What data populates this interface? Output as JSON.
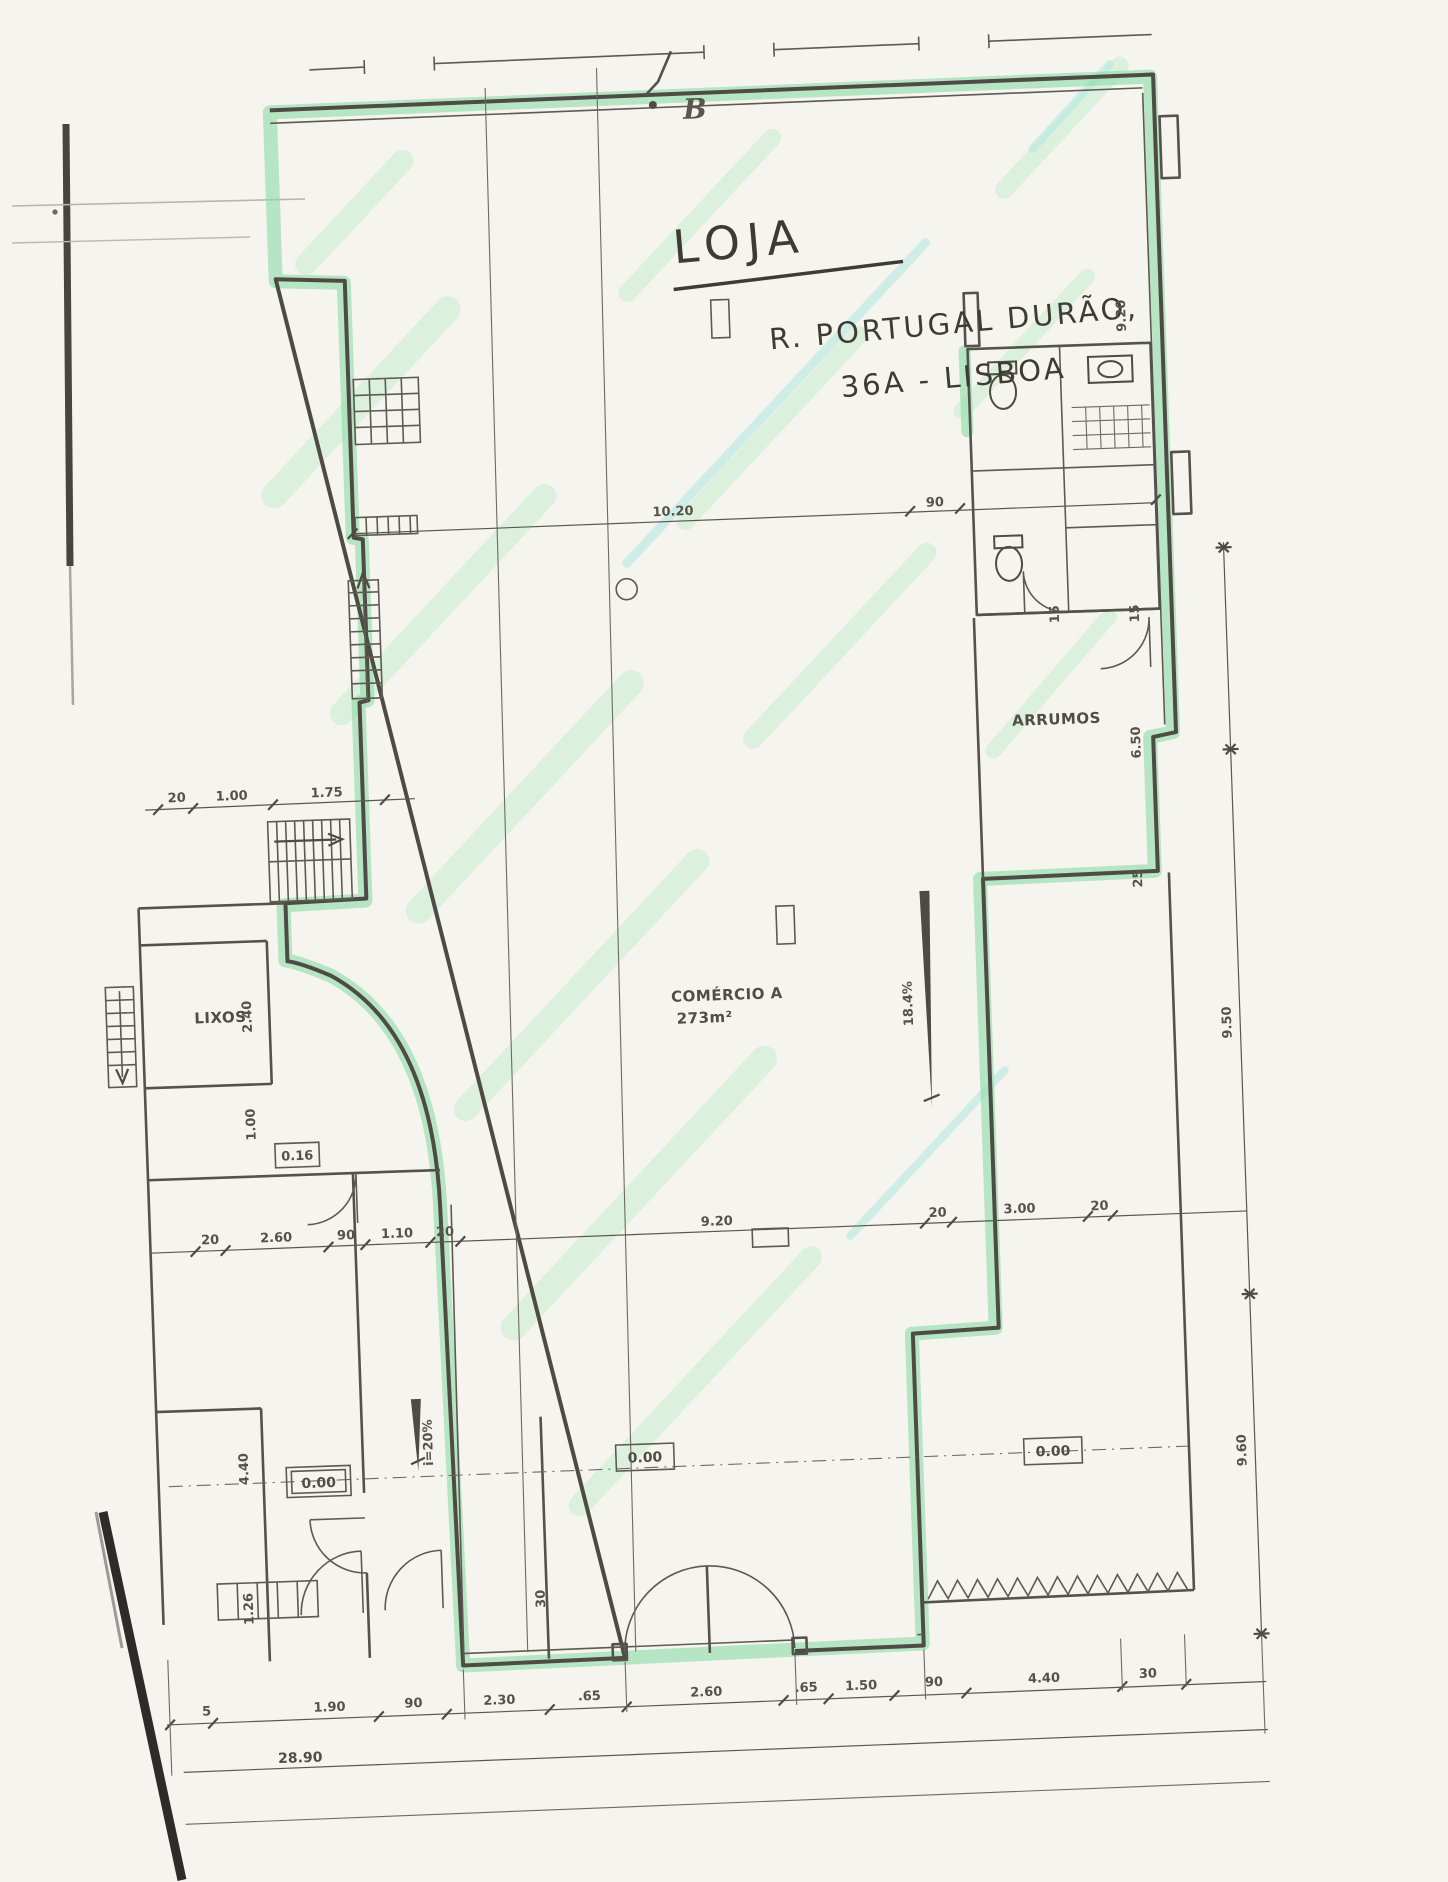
{
  "plan": {
    "section_marker": "B",
    "title": "LOJA",
    "address_line1": "R. PORTUGAL DURÃO,",
    "address_line2": "36A - LISBOA",
    "rooms": {
      "arrumos": "ARRUMOS",
      "lixos": "LIXOS",
      "comercio_name": "COMÉRCIO A",
      "comercio_area": "273m²"
    },
    "levels": {
      "left": "0.00",
      "center": "0.00",
      "right": "0.00",
      "small_upper": "0.16"
    },
    "ramps": {
      "left_label": "i=20%",
      "right_label": "18.4%"
    },
    "dims": {
      "top_span": "10.20",
      "top_right": "90",
      "middle_row": [
        "20",
        "2.60",
        "90",
        "1.10",
        "20",
        "9.20",
        "20",
        "3.00",
        "20"
      ],
      "bottom_row": [
        "5",
        "1.90",
        "90",
        "2.30",
        ".65",
        "2.60",
        ".65",
        "1.50",
        "90",
        "4.40",
        "30"
      ],
      "bottom_total": "28.90",
      "right_upper": "9.20",
      "right_storage": "6.50",
      "far_right_upper": "9.50",
      "far_right_lower": "9.60",
      "left_row": [
        "20",
        "1.00",
        "1.75"
      ],
      "lixos_height": "2.40",
      "left_mid": "1.00",
      "left_lower": "4.40",
      "left_bottom": "1.26",
      "door_width": "30",
      "wc_left": "15",
      "wc_right": "15",
      "wall_jog": "25"
    }
  },
  "colors": {
    "highlight_green": "#8fdca8",
    "streak_green": "#b9ecc6",
    "streak_cyan": "#a9e6e0",
    "ink": "#4e4b44",
    "paper": "#f5f4ee"
  }
}
